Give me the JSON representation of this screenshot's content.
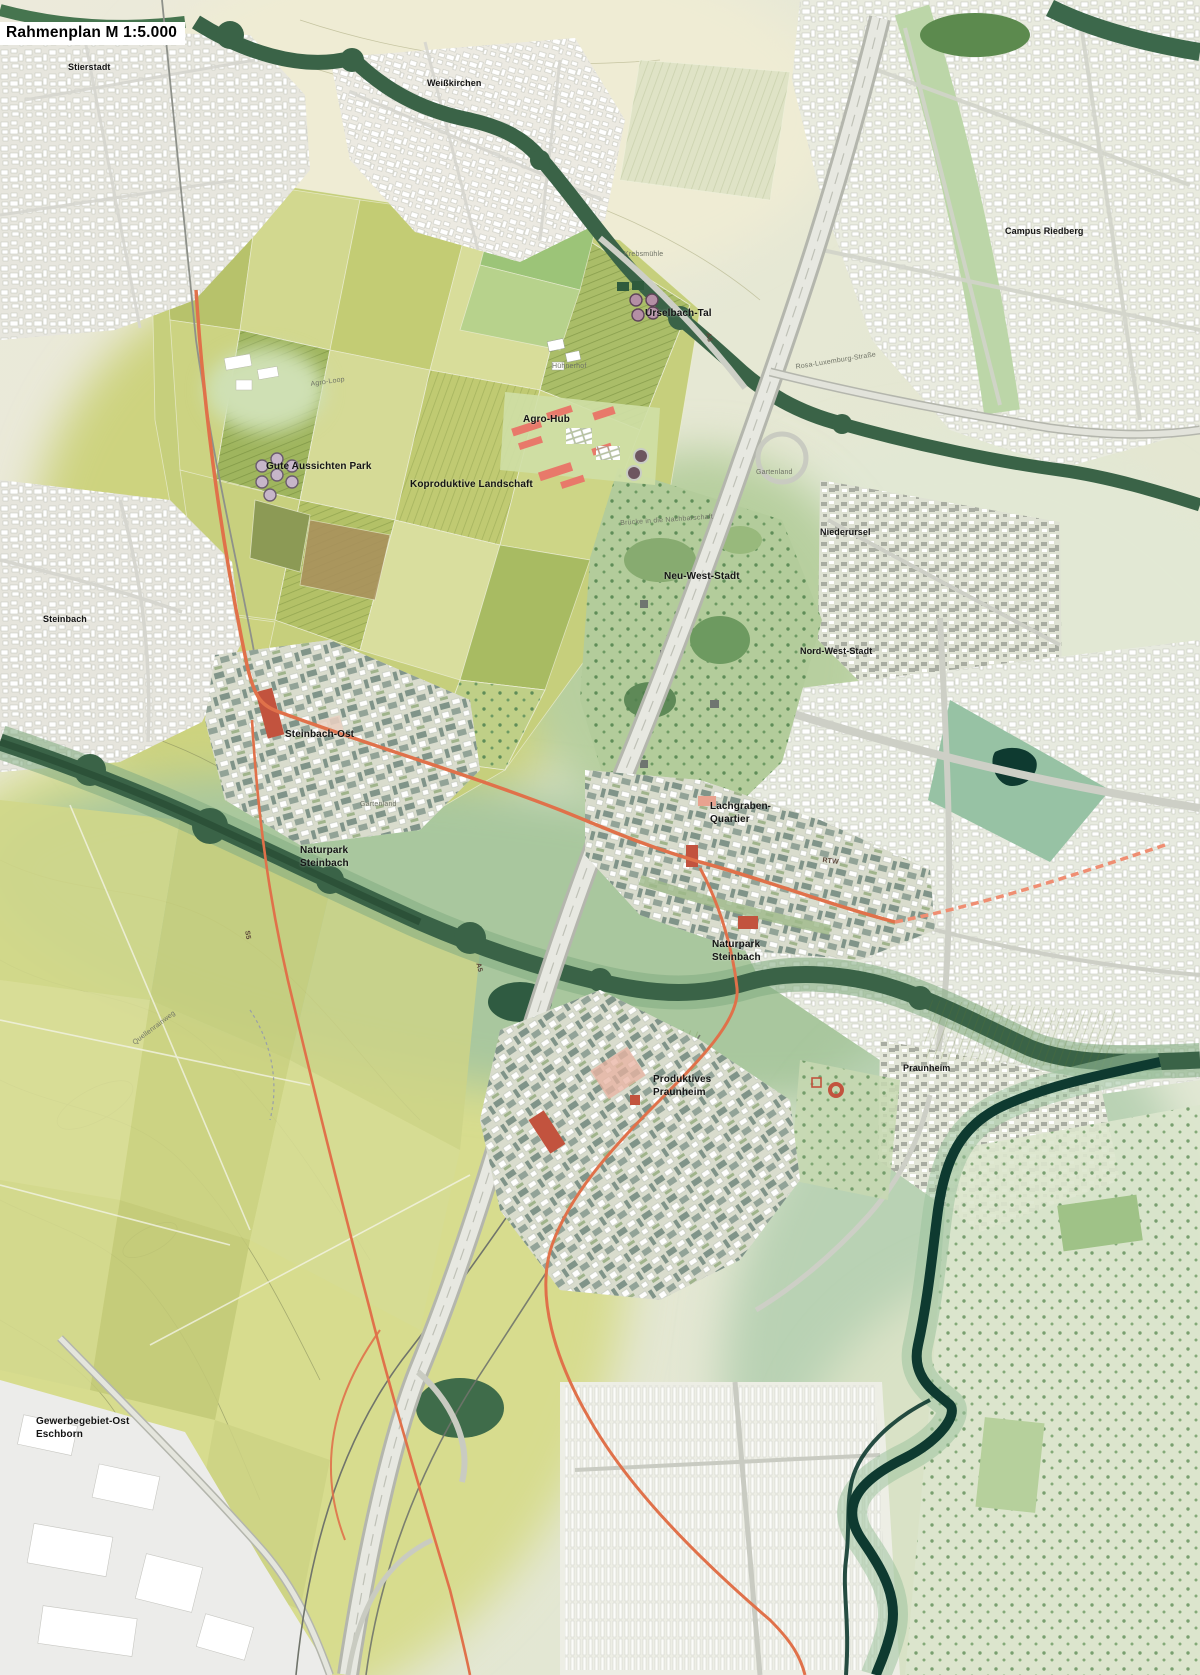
{
  "title": "Rahmenplan M 1:5.000",
  "palette": {
    "field_yellow": "#ccd37e",
    "forest_green": "#3a6347",
    "meadow_green": "#b5cd9d",
    "water_teal": "#0e3a30",
    "rtw_orange": "#e0714a",
    "accent_red": "#c2533e",
    "urban_light": "#e9e9e1",
    "label_black": "#141414",
    "label_gray": "#6f7366"
  },
  "labels": {
    "stierstadt": "Stierstadt",
    "weisskirchen": "Weißkirchen",
    "campus_riedberg": "Campus Riedberg",
    "urselbach_tal": "Urselbach-Tal",
    "agro_hub": "Agro-Hub",
    "gute_aussichten_park": "Gute Aussichten Park",
    "koproduktive_landschaft": "Koproduktive Landschaft",
    "niederursel": "Niederursel",
    "neu_west_stadt": "Neu-West-Stadt",
    "nord_west_stadt": "Nord-West-Stadt",
    "steinbach": "Steinbach",
    "steinbach_ost": "Steinbach-Ost",
    "lachgraben_quartier": "Lachgraben-\nQuartier",
    "naturpark_steinbach_1": "Naturpark\nSteinbach",
    "naturpark_steinbach_2": "Naturpark\nSteinbach",
    "produktives_praunheim": "Produktives\nPraunheim",
    "praunheim": "Praunheim",
    "gewerbegebiet_ost": "Gewerbegebiet-Ost\nEschborn",
    "agro_loop": "Agro-Loop",
    "krebsmuehle": "Krebsmühle",
    "huehnerhof": "Hühnerhof",
    "gartenland_1": "Gartenland",
    "gartenland_2": "Gartenland",
    "bruecke_nachbarschaft": "Brücke in die Nachbarschaft",
    "rosa_luxemburg": "Rosa-Luxemburg-Straße",
    "quellenrainweg": "Quellenrainweg",
    "rtw": "RTW",
    "a5_north": "A5",
    "a5_south": "A5",
    "s5": "S5"
  }
}
